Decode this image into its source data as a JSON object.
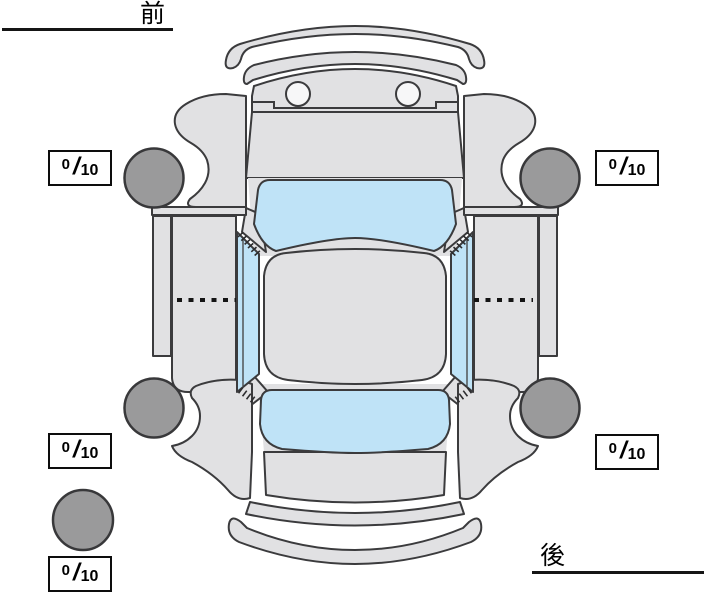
{
  "diagram": {
    "front_label": "前",
    "rear_label": "後",
    "description": "vehicle-top-view-condition-diagram"
  },
  "tires": {
    "separator": "/",
    "front_left": {
      "value": "0",
      "max": "10"
    },
    "front_right": {
      "value": "0",
      "max": "10"
    },
    "rear_left": {
      "value": "0",
      "max": "10"
    },
    "rear_right": {
      "value": "0",
      "max": "10"
    },
    "spare": {
      "value": "0",
      "max": "10"
    }
  },
  "colors": {
    "background": "#ffffff",
    "body_panel": "#e1e1e3",
    "glass": "#bfe3f7",
    "tire": "#9a9a9b",
    "outline": "#3b3b3d",
    "text": "#000000"
  }
}
